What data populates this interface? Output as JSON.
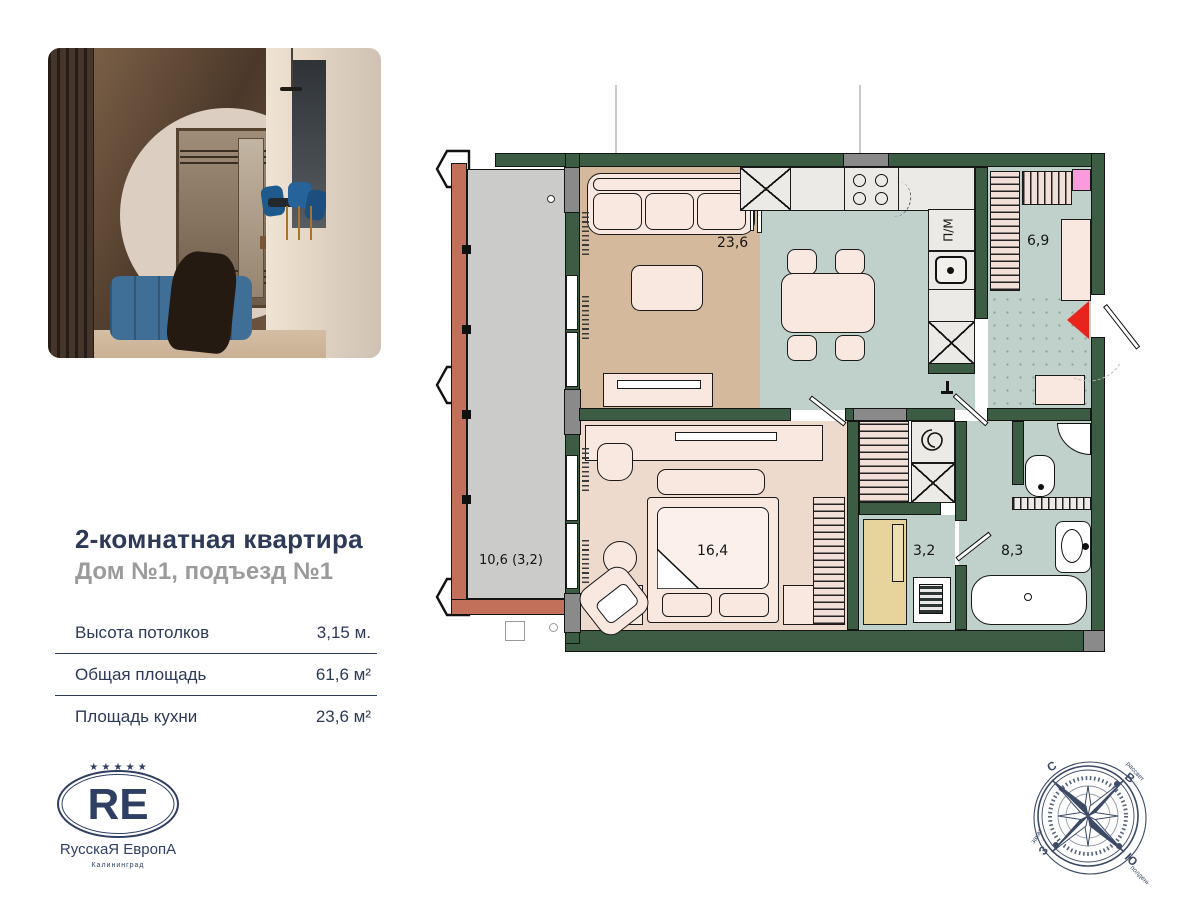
{
  "listing": {
    "title": "2-комнатная квартира",
    "subtitle": "Дом №1, подъезд №1",
    "specs": [
      {
        "label": "Высота потолков",
        "value": "3,15 м."
      },
      {
        "label": "Общая площадь",
        "value": "61,6 м²"
      },
      {
        "label": "Площадь кухни",
        "value": "23,6 м²"
      }
    ]
  },
  "logo": {
    "stars": "★ ★ ★ ★ ★",
    "monogram": "RE",
    "name": "RусскаЯ ЕвропА",
    "city": "Калининград"
  },
  "floorplan": {
    "rooms": [
      {
        "name": "living-room",
        "area": "23,6"
      },
      {
        "name": "hallway",
        "area": "6,9"
      },
      {
        "name": "bedroom",
        "area": "16,4"
      },
      {
        "name": "laundry",
        "area": "3,2"
      },
      {
        "name": "bathroom",
        "area": "8,3"
      },
      {
        "name": "loggia",
        "area": "10,6 (3,2)"
      }
    ],
    "kitchen": {
      "dishwasher": "П/М",
      "cabinet": "x"
    },
    "colors": {
      "wall": "#3d5c44",
      "kitchen_floor": "#bfd1ca",
      "living_floor": "#d5b99c",
      "bedroom_floor": "#eddacd",
      "loggia_floor": "#cbcbc9",
      "balcony_wall": "#c3705a",
      "accent_red": "#e8251d",
      "accent_pink": "#f99bdc",
      "navy": "#2c3a57"
    }
  },
  "compass": {
    "north": "С",
    "east": "В",
    "south": "Ю",
    "west": "З",
    "sunrise": "рассвет",
    "sunset": "закат",
    "noon": "полдень"
  }
}
